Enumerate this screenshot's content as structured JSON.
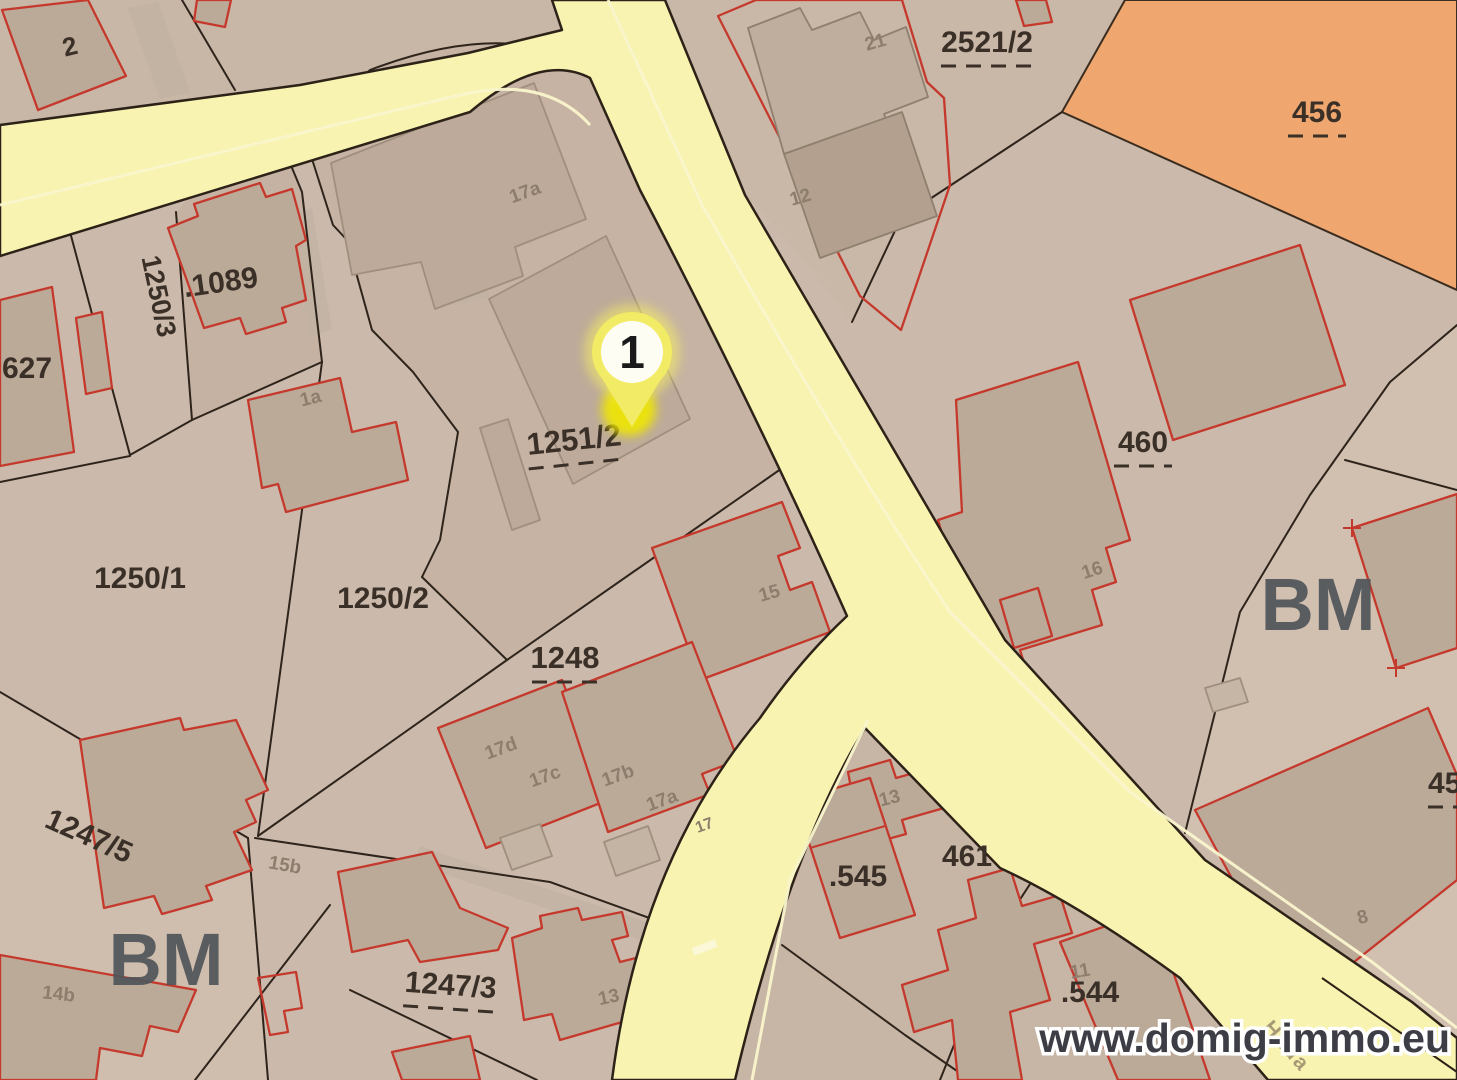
{
  "map": {
    "watermark": "www.domig-immo.eu",
    "street_label": "Hada",
    "marker": {
      "label": "1"
    },
    "zone_labels": [
      "BM",
      "BM"
    ],
    "colors": {
      "parcel_base": "#cbbaab",
      "parcel_orange": "#f0a76f",
      "road_yellow": "#f8f3b0",
      "road_stripe": "#faf6cd",
      "building_fill": "#bcaa99",
      "building_outline_red": "#c5392d",
      "boundary_dark": "#2e241b",
      "label_dark": "#3a3028",
      "label_building_gray": "#8d7d6c",
      "bm_gray": "#50555a",
      "marker_yellow": "#f2eb66",
      "marker_dot_yellow": "#f0e800"
    },
    "parcel_labels": [
      {
        "t": "2",
        "x": 72,
        "y": 55,
        "r": -14,
        "s": 26,
        "u": 0
      },
      {
        "t": ".1089",
        "x": 222,
        "y": 292,
        "r": -8,
        "s": 30,
        "u": 0
      },
      {
        "t": "627",
        "x": 2,
        "y": 378,
        "r": 0,
        "s": 30,
        "u": 0,
        "a": "start"
      },
      {
        "t": "1250/3",
        "x": 150,
        "y": 298,
        "r": 78,
        "s": 27,
        "u": 0
      },
      {
        "t": "1250/1",
        "x": 140,
        "y": 588,
        "r": 0,
        "s": 30,
        "u": 0
      },
      {
        "t": "1250/2",
        "x": 383,
        "y": 608,
        "r": 0,
        "s": 30,
        "u": 0
      },
      {
        "t": "1251/2",
        "x": 575,
        "y": 450,
        "r": -6,
        "s": 31,
        "u": 96
      },
      {
        "t": "1248",
        "x": 565,
        "y": 668,
        "r": 0,
        "s": 31,
        "u": 66
      },
      {
        "t": "1247/5",
        "x": 85,
        "y": 845,
        "r": 24,
        "s": 30,
        "u": 0
      },
      {
        "t": "1247/3",
        "x": 450,
        "y": 995,
        "r": 4,
        "s": 30,
        "u": 92
      },
      {
        "t": "2521/2",
        "x": 987,
        "y": 52,
        "r": 0,
        "s": 30,
        "u": 92
      },
      {
        "t": "456",
        "x": 1317,
        "y": 122,
        "r": 0,
        "s": 30,
        "u": 58
      },
      {
        "t": "460",
        "x": 1143,
        "y": 452,
        "r": 0,
        "s": 30,
        "u": 58
      },
      {
        "t": "461",
        "x": 967,
        "y": 866,
        "r": 0,
        "s": 30,
        "u": 0
      },
      {
        "t": ".545",
        "x": 858,
        "y": 886,
        "r": 0,
        "s": 30,
        "u": 0
      },
      {
        "t": ".544",
        "x": 1090,
        "y": 1002,
        "r": 0,
        "s": 30,
        "u": 0
      },
      {
        "t": "45",
        "x": 1428,
        "y": 793,
        "r": 0,
        "s": 30,
        "u": 46,
        "a": "start"
      }
    ],
    "building_labels": [
      {
        "t": "17a",
        "x": 527,
        "y": 198,
        "r": -20
      },
      {
        "t": "21",
        "x": 877,
        "y": 48,
        "r": -16
      },
      {
        "t": "12",
        "x": 802,
        "y": 203,
        "r": -16
      },
      {
        "t": "1a",
        "x": 312,
        "y": 404,
        "r": -14
      },
      {
        "t": "15",
        "x": 771,
        "y": 599,
        "r": -16
      },
      {
        "t": "16",
        "x": 1094,
        "y": 576,
        "r": -18
      },
      {
        "t": "17d",
        "x": 503,
        "y": 754,
        "r": -20
      },
      {
        "t": "17c",
        "x": 547,
        "y": 782,
        "r": -20
      },
      {
        "t": "17b",
        "x": 620,
        "y": 781,
        "r": -20
      },
      {
        "t": "17a",
        "x": 664,
        "y": 806,
        "r": -20
      },
      {
        "t": "17",
        "x": 706,
        "y": 830,
        "r": -20,
        "s": 16
      },
      {
        "t": "13",
        "x": 891,
        "y": 804,
        "r": -14
      },
      {
        "t": "11",
        "x": 1081,
        "y": 977,
        "r": -10
      },
      {
        "t": "13",
        "x": 610,
        "y": 1003,
        "r": -12
      },
      {
        "t": "15b",
        "x": 284,
        "y": 871,
        "r": 10
      },
      {
        "t": "14b",
        "x": 58,
        "y": 1000,
        "r": 6
      },
      {
        "t": "8",
        "x": 1364,
        "y": 923,
        "r": -14
      }
    ]
  }
}
